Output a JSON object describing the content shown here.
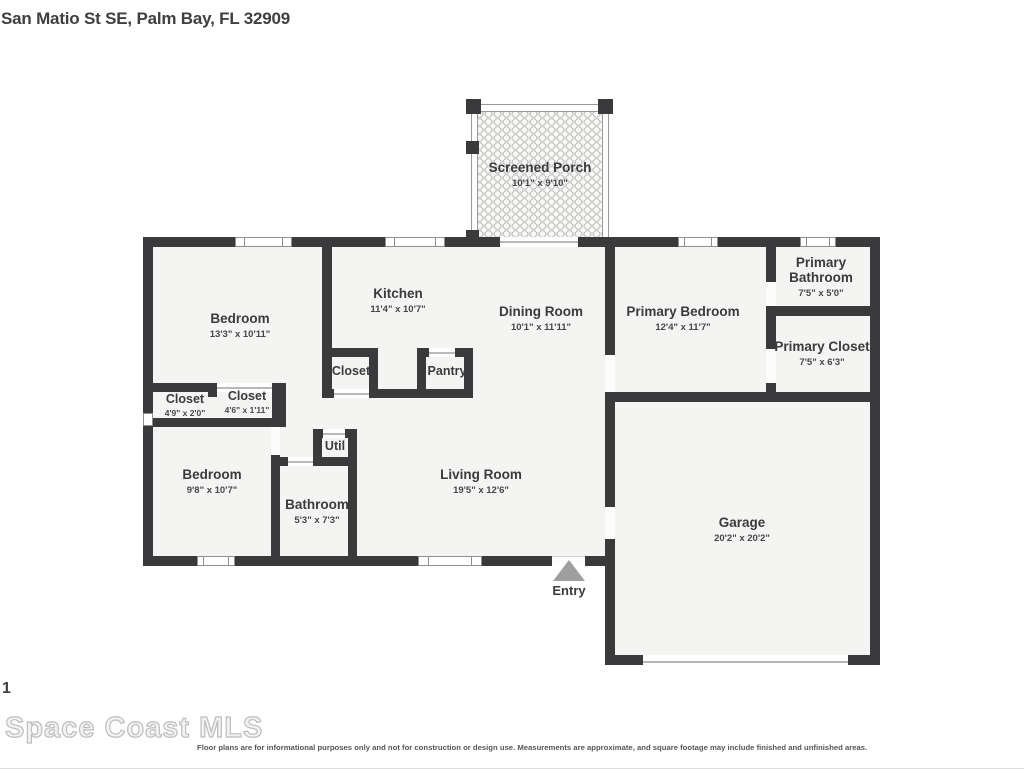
{
  "header": {
    "title": "San Matio St SE, Palm Bay, FL 32909"
  },
  "rooms": [
    {
      "id": "screened-porch",
      "name": "Screened Porch",
      "dims": "10'1\" x 9'10\""
    },
    {
      "id": "bedroom-1",
      "name": "Bedroom",
      "dims": "13'3\" x 10'11\""
    },
    {
      "id": "kitchen",
      "name": "Kitchen",
      "dims": "11'4\" x 10'7\""
    },
    {
      "id": "dining-room",
      "name": "Dining Room",
      "dims": "10'1\" x 11'11\""
    },
    {
      "id": "primary-bedroom",
      "name": "Primary Bedroom",
      "dims": "12'4\" x 11'7\""
    },
    {
      "id": "primary-bathroom",
      "name": "Primary Bathroom",
      "dims": "7'5\" x 5'0\""
    },
    {
      "id": "primary-closet",
      "name": "Primary Closet",
      "dims": "7'5\" x 6'3\""
    },
    {
      "id": "closet-kitchen",
      "name": "Closet",
      "dims": ""
    },
    {
      "id": "pantry",
      "name": "Pantry",
      "dims": ""
    },
    {
      "id": "closet-1",
      "name": "Closet",
      "dims": "4'9\" x 2'0\""
    },
    {
      "id": "closet-2",
      "name": "Closet",
      "dims": "4'6\" x 1'11\""
    },
    {
      "id": "util",
      "name": "Util",
      "dims": ""
    },
    {
      "id": "bedroom-2",
      "name": "Bedroom",
      "dims": "9'8\" x 10'7\""
    },
    {
      "id": "bathroom",
      "name": "Bathroom",
      "dims": "5'3\" x 7'3\""
    },
    {
      "id": "living-room",
      "name": "Living Room",
      "dims": "19'5\" x 12'6\""
    },
    {
      "id": "garage",
      "name": "Garage",
      "dims": "20'2\" x 20'2\""
    }
  ],
  "entry": {
    "label": "Entry"
  },
  "footer": {
    "page_number": "1",
    "mls_logo": "Space Coast MLS",
    "disclaimer": "Floor plans are for informational purposes only and not for construction or design use. Measurements are approximate, and square footage may include finished and unfinished areas."
  },
  "colors": {
    "wall": "#3a3a3c",
    "floor": "#f4f4f3",
    "text": "#3b3b3e",
    "arrow": "#9e9e9e",
    "mls": "#bdbdbd"
  }
}
